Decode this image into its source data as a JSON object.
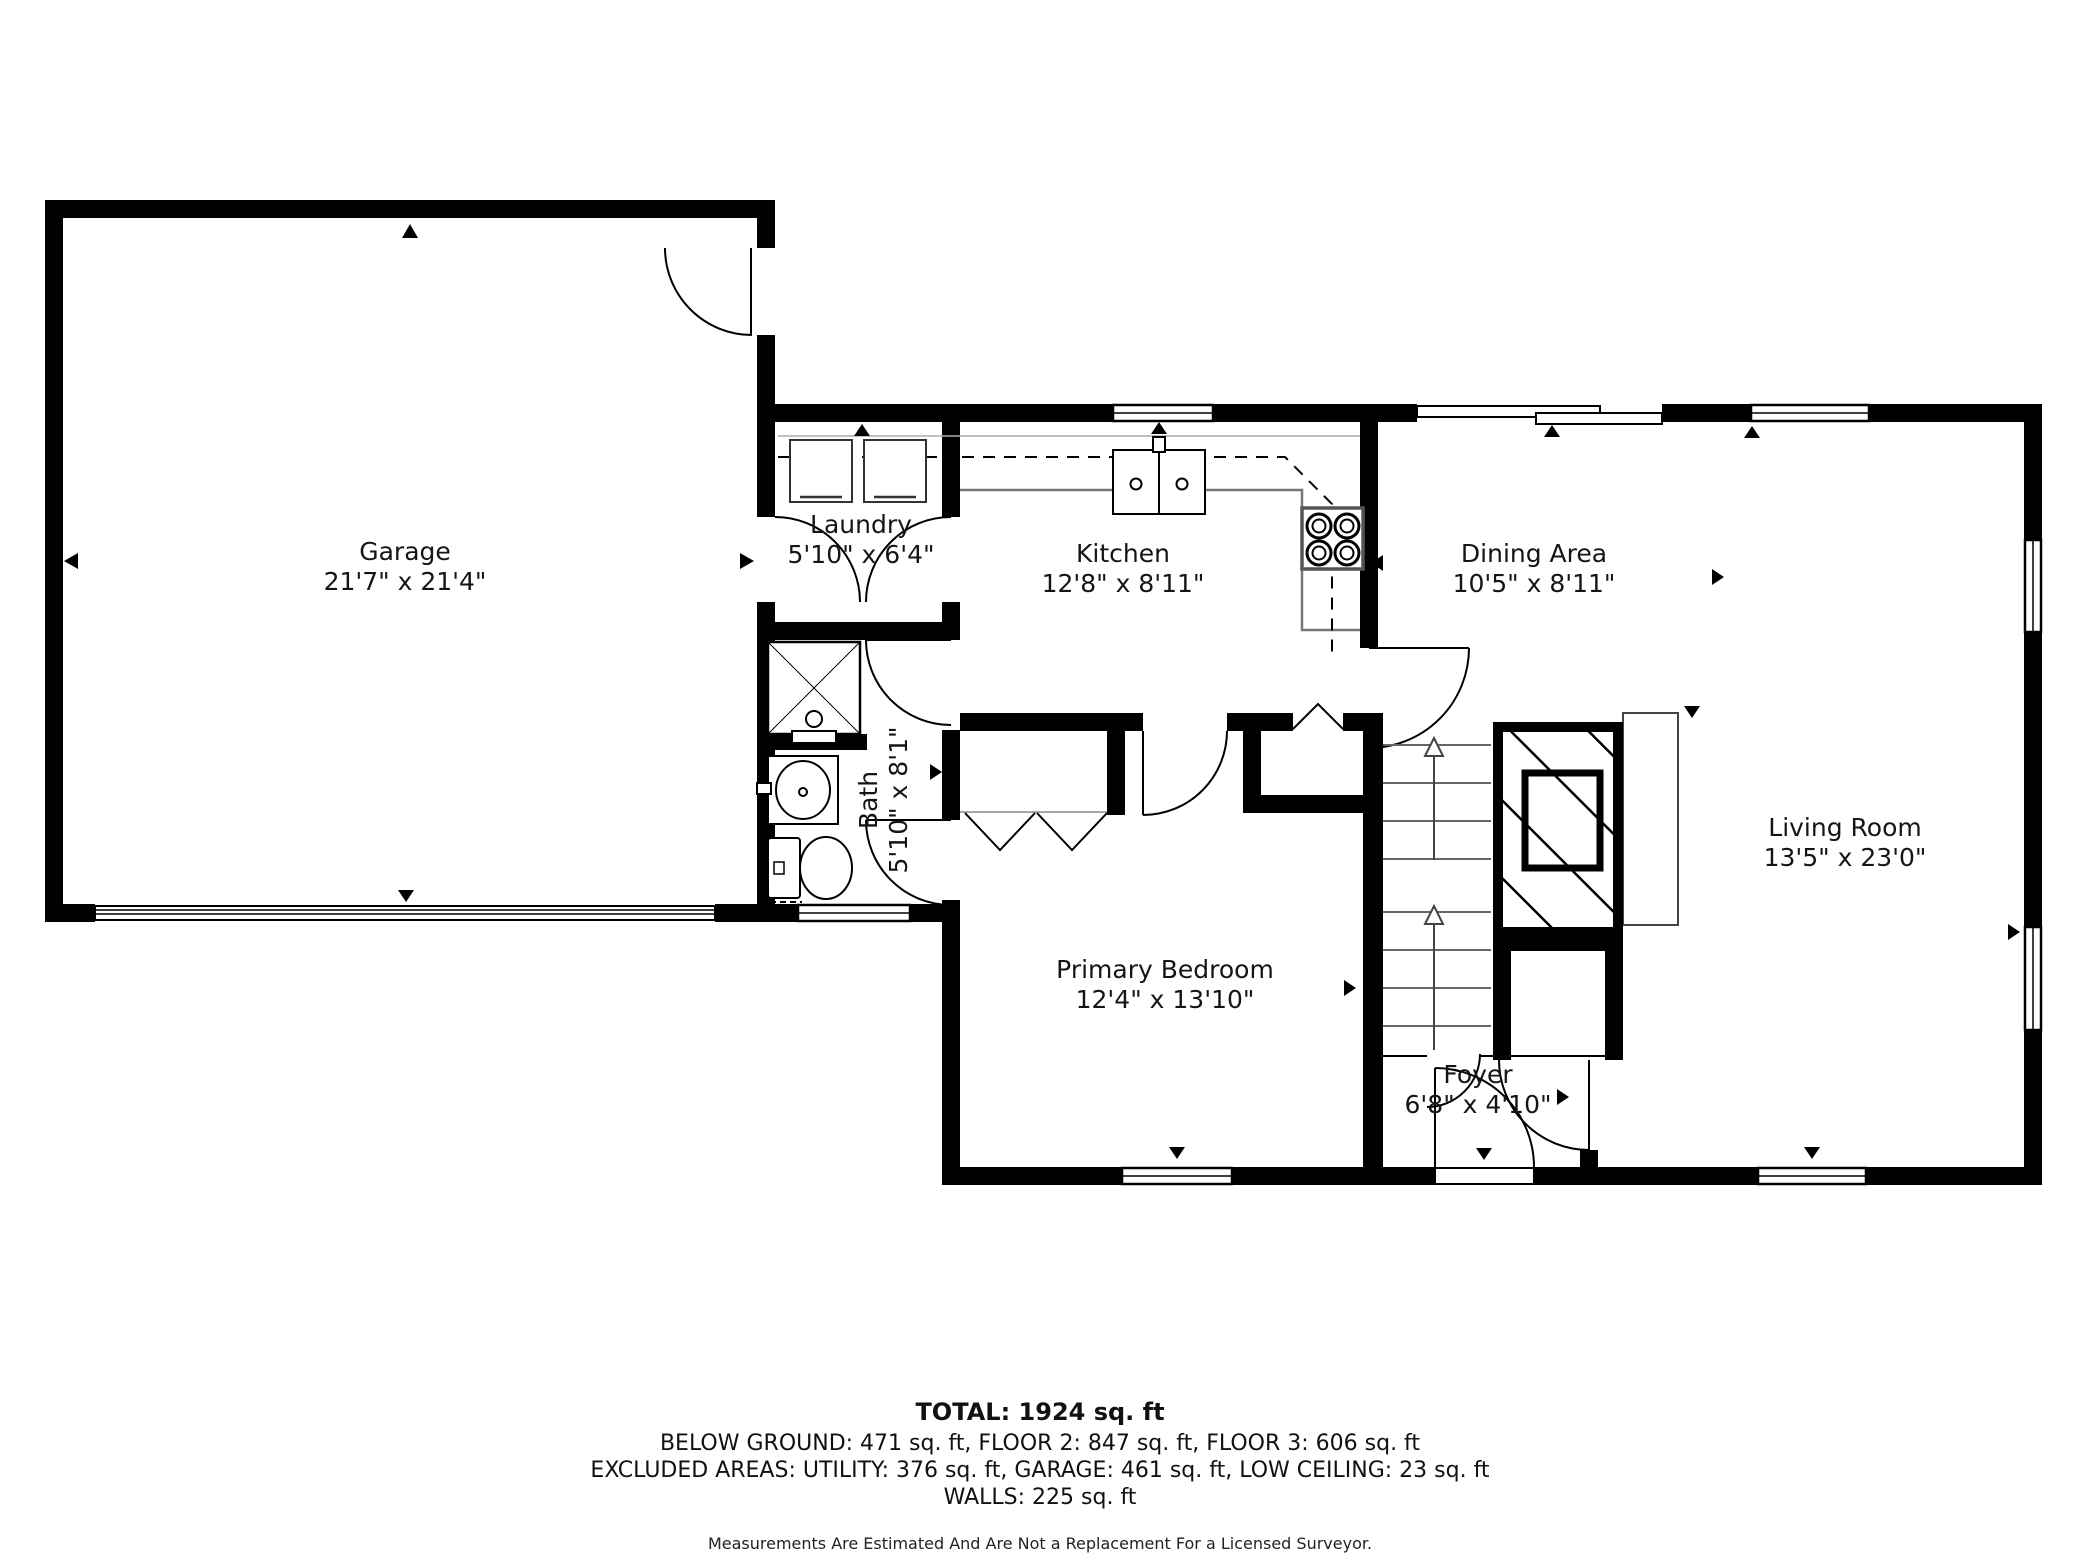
{
  "rooms": [
    {
      "name": "Garage",
      "dims": "21'7\" x 21'4\""
    },
    {
      "name": "Laundry",
      "dims": "5'10\" x 6'4\""
    },
    {
      "name": "Kitchen",
      "dims": "12'8\" x 8'11\""
    },
    {
      "name": "Dining Area",
      "dims": "10'5\" x 8'11\""
    },
    {
      "name": "Bath",
      "dims": "5'10\" x 8'1\""
    },
    {
      "name": "Primary Bedroom",
      "dims": "12'4\" x 13'10\""
    },
    {
      "name": "Living Room",
      "dims": "13'5\" x 23'0\""
    },
    {
      "name": "Foyer",
      "dims": "6'8\" x 4'10\""
    }
  ],
  "footer": {
    "total": "TOTAL: 1924 sq. ft",
    "floors": "BELOW GROUND: 471 sq. ft, FLOOR 2: 847 sq. ft, FLOOR 3: 606 sq. ft",
    "excluded": "EXCLUDED AREAS: UTILITY: 376 sq. ft, GARAGE: 461 sq. ft, LOW CEILING: 23 sq. ft",
    "walls": "WALLS: 225 sq. ft",
    "disclaimer": "Measurements Are Estimated And Are Not a Replacement For a Licensed Surveyor."
  },
  "colors": {
    "wall": "#000000",
    "counter": "#777777",
    "tread": "#666666",
    "background": "#ffffff"
  }
}
